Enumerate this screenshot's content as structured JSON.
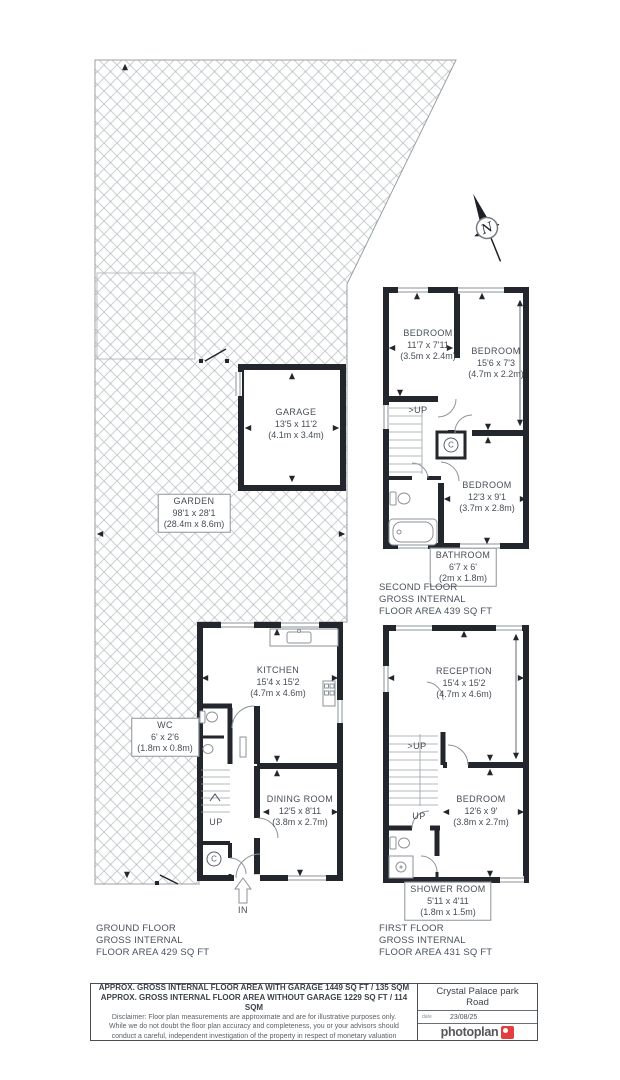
{
  "compass": {
    "label": "N"
  },
  "garden": {
    "name": "GARDEN",
    "imperial": "98'1 x 28'1",
    "metric": "(28.4m x 8.6m)"
  },
  "garage": {
    "name": "GARAGE",
    "imperial": "13'5 x 11'2",
    "metric": "(4.1m x 3.4m)"
  },
  "second_floor": {
    "bedroom1": {
      "name": "BEDROOM",
      "imperial": "11'7 x 7'11",
      "metric": "(3.5m x 2.4m)"
    },
    "bedroom2": {
      "name": "BEDROOM",
      "imperial": "15'6 x 7'3",
      "metric": "(4.7m x 2.2m)"
    },
    "bedroom3": {
      "name": "BEDROOM",
      "imperial": "12'3 x 9'1",
      "metric": "(3.7m x 2.8m)"
    },
    "bathroom": {
      "name": "BATHROOM",
      "imperial": "6'7 x 6'",
      "metric": "(2m x 1.8m)"
    },
    "up": ">UP",
    "cupboard": "C",
    "caption": {
      "l1": "SECOND FLOOR",
      "l2": "GROSS INTERNAL",
      "l3": "FLOOR AREA 439 SQ FT"
    }
  },
  "ground_floor": {
    "kitchen": {
      "name": "KITCHEN",
      "imperial": "15'4 x 15'2",
      "metric": "(4.7m x 4.6m)"
    },
    "wc": {
      "name": "WC",
      "imperial": "6' x 2'6",
      "metric": "(1.8m x 0.8m)"
    },
    "dining": {
      "name": "DINING ROOM",
      "imperial": "12'5 x 8'11",
      "metric": "(3.8m x 2.7m)"
    },
    "up": "UP",
    "cupboard": "C",
    "entrance": "IN",
    "caption": {
      "l1": "GROUND FLOOR",
      "l2": "GROSS INTERNAL",
      "l3": "FLOOR AREA 429 SQ FT"
    }
  },
  "first_floor": {
    "reception": {
      "name": "RECEPTION",
      "imperial": "15'4 x 15'2",
      "metric": "(4.7m x 4.6m)"
    },
    "bedroom": {
      "name": "BEDROOM",
      "imperial": "12'6 x 9'",
      "metric": "(3.8m x 2.7m)"
    },
    "shower": {
      "name": "SHOWER ROOM",
      "imperial": "5'11 x 4'11",
      "metric": "(1.8m x 1.5m)"
    },
    "up1": ">UP",
    "up2": "UP",
    "caption": {
      "l1": "FIRST FLOOR",
      "l2": "GROSS INTERNAL",
      "l3": "FLOOR AREA 431 SQ FT"
    }
  },
  "footer": {
    "area_with_garage": "APPROX. GROSS INTERNAL FLOOR AREA WITH GARAGE 1449 SQ FT / 135 SQM",
    "area_without_garage": "APPROX. GROSS INTERNAL FLOOR AREA WITHOUT GARAGE 1229 SQ FT / 114 SQM",
    "disclaimer_l1": "Disclaimer: Floor plan measurements are approximate and are for illustrative purposes only.",
    "disclaimer_l2": "While we do not doubt the floor plan accuracy and completeness, you or your advisors should",
    "disclaimer_l3": "conduct a careful, independent investigation of the property in respect of monetary valuation",
    "address_l1": "Crystal Palace park",
    "address_l2": "Road",
    "date_label": "date",
    "date": "23/08/25",
    "brand": "photoplan"
  },
  "colors": {
    "wall": "#23262d",
    "light": "#8d939a",
    "accent_red": "#e23d3f"
  }
}
